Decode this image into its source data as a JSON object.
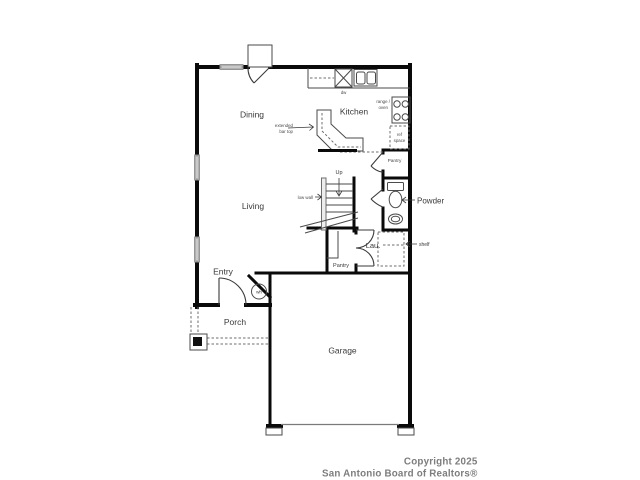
{
  "rooms": {
    "dining": "Dining",
    "kitchen": "Kitchen",
    "living": "Living",
    "entry": "Entry",
    "porch": "Porch",
    "garage": "Garage",
    "powder": "Powder",
    "laundry": "Lau.",
    "pantry_hall": "Pantry",
    "pantry_understairs": "Pantry"
  },
  "annotations": {
    "up": "Up",
    "low_wall": "low wall",
    "extended_bar_line1": "extended",
    "extended_bar_line2": "bar top",
    "dw": "dw",
    "range_line1": "range /",
    "range_line2": "oven",
    "ref_line1": "ref",
    "ref_line2": "space",
    "shelf": "shelf",
    "wh": "wh"
  },
  "footer": {
    "line1": "Copyright 2025",
    "line2": "San Antonio Board of Realtors®"
  },
  "colors": {
    "wall": "#0a0a0a",
    "thin_line": "#4a4a4a",
    "window": "#d9d9d9",
    "label_text": "#3a3a3a",
    "footer_text": "#7d7d7d",
    "background": "#ffffff"
  }
}
